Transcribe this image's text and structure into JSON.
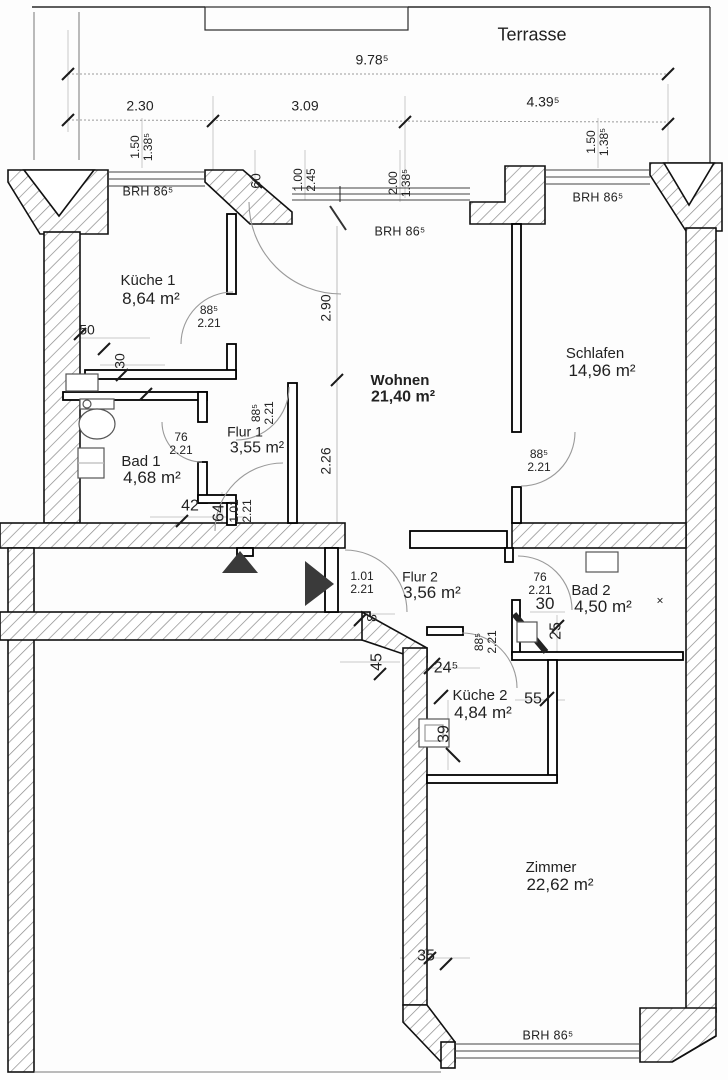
{
  "drawing": {
    "type": "floor-plan",
    "terrace_label": "Terrasse",
    "brh_label": "BRH 86⁵",
    "marker": "×"
  },
  "rooms": {
    "kueche1": {
      "label": "Küche 1",
      "area": "8,64 m²"
    },
    "wohnen": {
      "label": "Wohnen",
      "area": "21,40 m²"
    },
    "schlafen": {
      "label": "Schlafen",
      "area": "14,96 m²"
    },
    "flur1": {
      "label": "Flur 1",
      "area": "3,55 m²"
    },
    "bad1": {
      "label": "Bad 1",
      "area": "4,68 m²"
    },
    "flur2": {
      "label": "Flur 2",
      "area": "3,56 m²"
    },
    "bad2": {
      "label": "Bad 2",
      "area": "4,50 m²"
    },
    "kueche2": {
      "label": "Küche 2",
      "area": "4,84 m²"
    },
    "zimmer": {
      "label": "Zimmer",
      "area": "22,62 m²"
    }
  },
  "dimensions": {
    "total_width": "9.78⁵",
    "seg_left": "2.30",
    "seg_mid": "3.09",
    "seg_right": "4.39⁵",
    "window_left": "1.50\n1.38⁵",
    "window_right": "1.50\n1.38⁵",
    "pillar_width": "60",
    "balcony_door": "1.00\n2.45",
    "wohnen_window": "2.00\n1.38⁵",
    "wohnen_depth_upper": "2.90",
    "wohnen_depth_lower": "2.26",
    "wall_50": "50",
    "shaft_30": "30",
    "door_kueche1": "88⁵\n2.21",
    "door_bad1": "76\n2.21",
    "door_flur1": "88⁵\n2.21",
    "door_schlafen": "88⁵\n2.21",
    "door_bad2": "76\n2.21",
    "door_kueche2": "88⁵\n2.21",
    "entry_flur1": "1.01\n2.21",
    "entry_flur2": "1.01\n2.21",
    "step_42": "42",
    "step_64": "64",
    "wall_8": "8",
    "bad2_30": "30",
    "bad2_25": "25",
    "wall_45": "45",
    "wall_245": "24⁵",
    "wall_55": "55",
    "wall_39": "39",
    "wall_35": "35"
  },
  "colors": {
    "wall_outline": "#111111",
    "hatch": "#8a8a8a",
    "dimension_line": "#9a9a9a",
    "door_arc": "#9a9a9a",
    "arrow_fill": "#3a3a3a"
  }
}
